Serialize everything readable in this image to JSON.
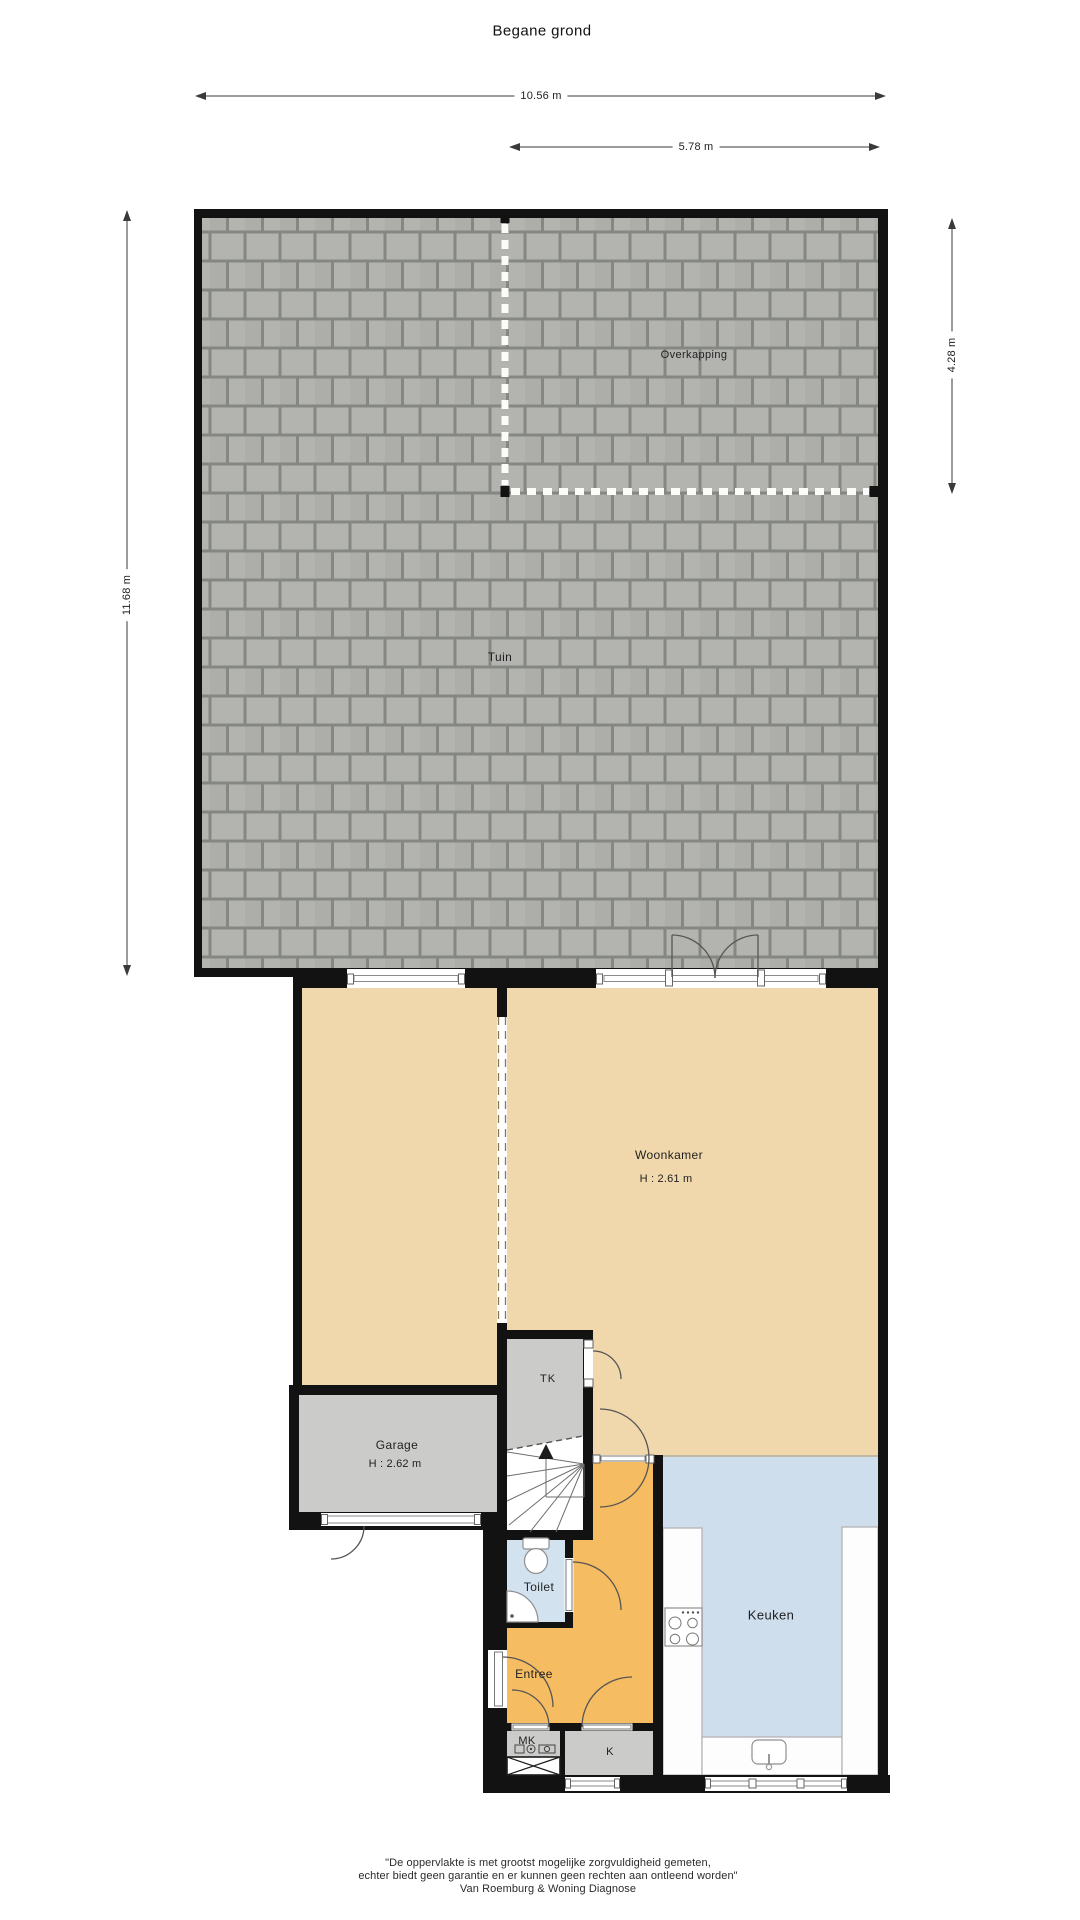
{
  "title": "Begane grond",
  "dimensions": {
    "total_width": "10.56 m",
    "overkapping_width": "5.78 m",
    "total_height": "11.68 m",
    "overkapping_height": "4.28 m"
  },
  "rooms": {
    "tuin": "Tuin",
    "overkapping": "Overkapping",
    "woonkamer": "Woonkamer",
    "woonkamer_height": "H : 2.61 m",
    "garage": "Garage",
    "garage_height": "H : 2.62 m",
    "tk": "TK",
    "toilet": "Toilet",
    "entree": "Entree",
    "keuken": "Keuken",
    "mk": "MK",
    "k": "K"
  },
  "footer": {
    "line1": "\"De oppervlakte is met grootst mogelijke zorgvuldigheid gemeten,",
    "line2": "echter biedt geen garantie en er kunnen geen rechten aan ontleend worden\"",
    "line3": "Van Roemburg & Woning Diagnose"
  },
  "colors": {
    "wall": "#121212",
    "tile": "#b3b4b0",
    "tile_alt": "#adaeaa",
    "tile_joint": "#858783",
    "floor_beige": "#f0d8ac",
    "floor_orange": "#f6bc62",
    "floor_blue": "#cfdeed",
    "floor_toilet": "#d3e2ef",
    "floor_gray": "#cbcbc9"
  }
}
